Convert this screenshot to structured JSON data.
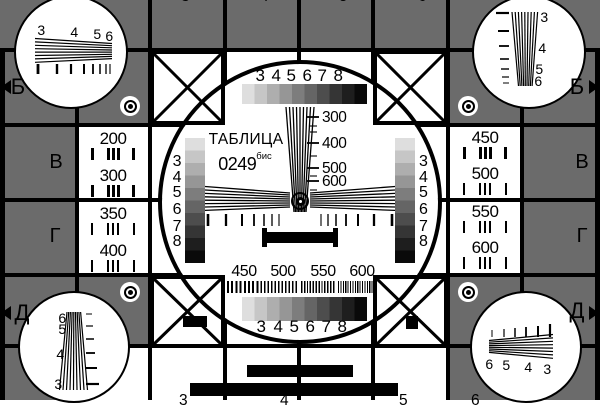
{
  "title": {
    "word": "ТАБЛИЦА",
    "number": "0249",
    "suffix": "бис"
  },
  "row_labels": {
    "left": [
      "Б",
      "В",
      "Г",
      "Д"
    ],
    "right": [
      "Б",
      "В",
      "Г",
      "Д"
    ]
  },
  "vertical_scale_labels": [
    "300",
    "400",
    "500",
    "600"
  ],
  "grayscale_numbers": [
    "3",
    "4",
    "5",
    "6",
    "7",
    "8"
  ],
  "bottom_burst_labels": [
    "450",
    "500",
    "550",
    "600"
  ],
  "side_frequency_labels": {
    "left": [
      "200",
      "300",
      "350",
      "400"
    ],
    "right": [
      "450",
      "500",
      "550",
      "600"
    ]
  },
  "corner_wedge_numbers": {
    "top_left": [
      "3",
      "4",
      "5",
      "6"
    ],
    "top_right": [
      "3",
      "4",
      "5",
      "6"
    ],
    "bottom_left": [
      "6",
      "5",
      "4",
      "3"
    ],
    "bottom_right": [
      "6",
      "5",
      "4",
      "3"
    ]
  },
  "edge_partial_digits": {
    "top": [
      "3",
      "4",
      "5",
      "6"
    ],
    "bottom": [
      "3",
      "4",
      "5",
      "6"
    ]
  },
  "colors": {
    "background_gray": "#6b6b6b",
    "line_black": "#000000",
    "white": "#ffffff",
    "grayscale_steps": [
      "#dedede",
      "#c6c6c6",
      "#aeaeae",
      "#969696",
      "#7d7d7d",
      "#656565",
      "#4d4d4d",
      "#353535",
      "#1e1e1e",
      "#0a0a0a"
    ]
  }
}
